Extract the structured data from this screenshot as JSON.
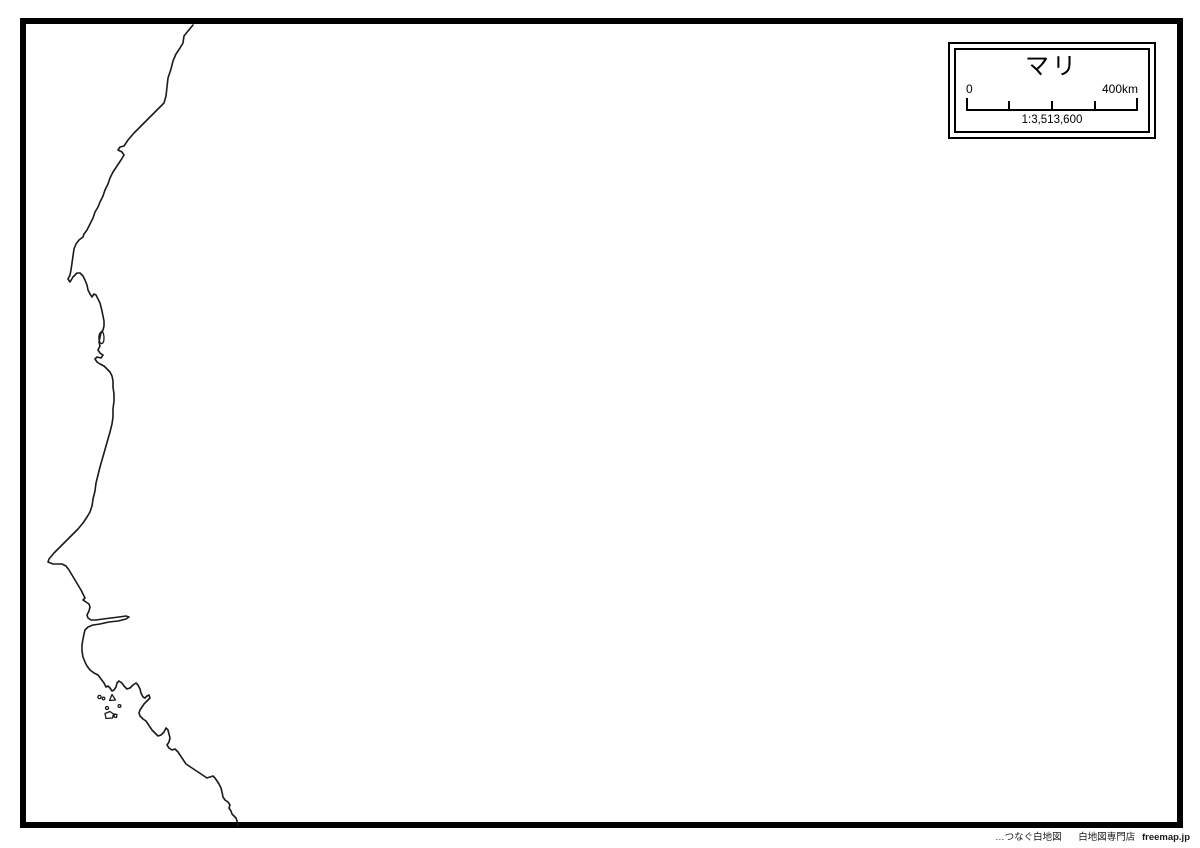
{
  "map": {
    "title": "マリ",
    "scalebar": {
      "start_label": "0",
      "end_label": "400km",
      "ratio": "1:3,513,600"
    },
    "credit": {
      "tagline": "…つなぐ白地図",
      "shop": "白地図専門店",
      "site": "freemap.jp"
    },
    "colors": {
      "line": "#1a1a1a",
      "frame": "#000000",
      "background": "#ffffff"
    },
    "geometry": {
      "coastline": "M193,25 L188,31 184,36 183,43 180,48 176,54 173,61 171,69 168,78 167,87 166,96 164,103 160,107 156,111 151,116 146,121 140,127 134,133 128,140 124,146 120,147 118,150 122,152 124,155 121,160 117,166 113,172 110,178 108,184 105,190 103,196 100,202 98,207 95,212 93,218 90,224 87,230 84,234 83,237 79,240 76,244 74,249 73,256 72,263 71,270 70,275 68,279 70,282 73,277 77,273 80,273 83,276 85,280 87,285 88,290 90,294 92,297 94,294 96,295 98,299 100,303 101,307 102,311 103,316 104,321 104,326 103,330 101,333 100,337 99,342 100,346 98,350 100,353 103,355 101,358 97,357 95,359 97,362 100,364 104,366 107,369 110,372 112,376 113,381 113,387 114,394 114,401 113,409 113,417 112,424 110,432 108,439 106,446 104,453 102,460 100,467 98,475 96,483 95,491 93,499 92,506 90,512 87,517 83,523 78,529 72,535 66,541 60,547 54,553 49,559 48,562 53,564 58,564 62,564 66,566 69,570 72,575 75,580 78,585 81,590 83,594 85,598 83,600 86,602 89,604 90,607 89,611 87,615 88,618 91,620 96,620 103,619 111,618 119,617 126,616 129,617 126,619 118,621 109,622 100,624 93,625 88,627 85,630 84,634 83,639 82,645 82,651 83,657 85,662 87,666 90,670 94,673 98,675 101,679 104,683 106,687 108,686 110,688 112,691 114,690 116,687 117,683 119,681 122,683 124,686 127,689 130,688 133,685 136,683 138,685 140,689 141,693 143,697 145,698 147,696 149,695 150,698 147,701 144,704 142,707 140,710 139,713 140,716 143,719 146,721 148,724 150,727 152,730 155,733 158,736 161,735 164,732 166,728 168,730 169,734 170,738 169,742 167,745 169,748 172,750 175,749 178,752 180,755 182,758 184,761 186,764 189,766 192,768 195,770 198,772 201,774 204,776 207,778 210,777 213,776 215,778 217,781 219,784 221,788 222,792 223,797 225,800 228,802 230,805 229,808 231,811 232,814 234,816 236,818 237,821 238,825",
      "islands": [
        "M101.5,331.5 C99.5,333 98.5,336 99,339.5 C99.3,342.5 101,344.5 102.8,343 C104.2,341.5 104.3,337 103.5,334 C103,332 102.3,331 101.5,331.5 Z",
        "M97.9,697 a1.6,1.6 0 1 0 3.2,0 a1.6,1.6 0 1 0 -3.2,0 Z",
        "M102.2,698.5 a1.3,1.3 0 1 0 2.6,0 a1.3,1.3 0 1 0 -2.6,0 Z",
        "M112,694.5 L115.5,700 109.5,700.5 Z",
        "M105.5,708 a1.5,1.5 0 1 0 3,0 a1.5,1.5 0 1 0 -3,0 Z",
        "M105,713.5 L110,711.5 113.5,714 112.5,718 106,718.5 Z",
        "M114.5,714 L117,714.5 116.5,717.5 114,717 Z",
        "M118.1,706 a1.4,1.4 0 1 0 2.8,0 a1.4,1.4 0 1 0 -2.8,0 Z"
      ]
    }
  }
}
